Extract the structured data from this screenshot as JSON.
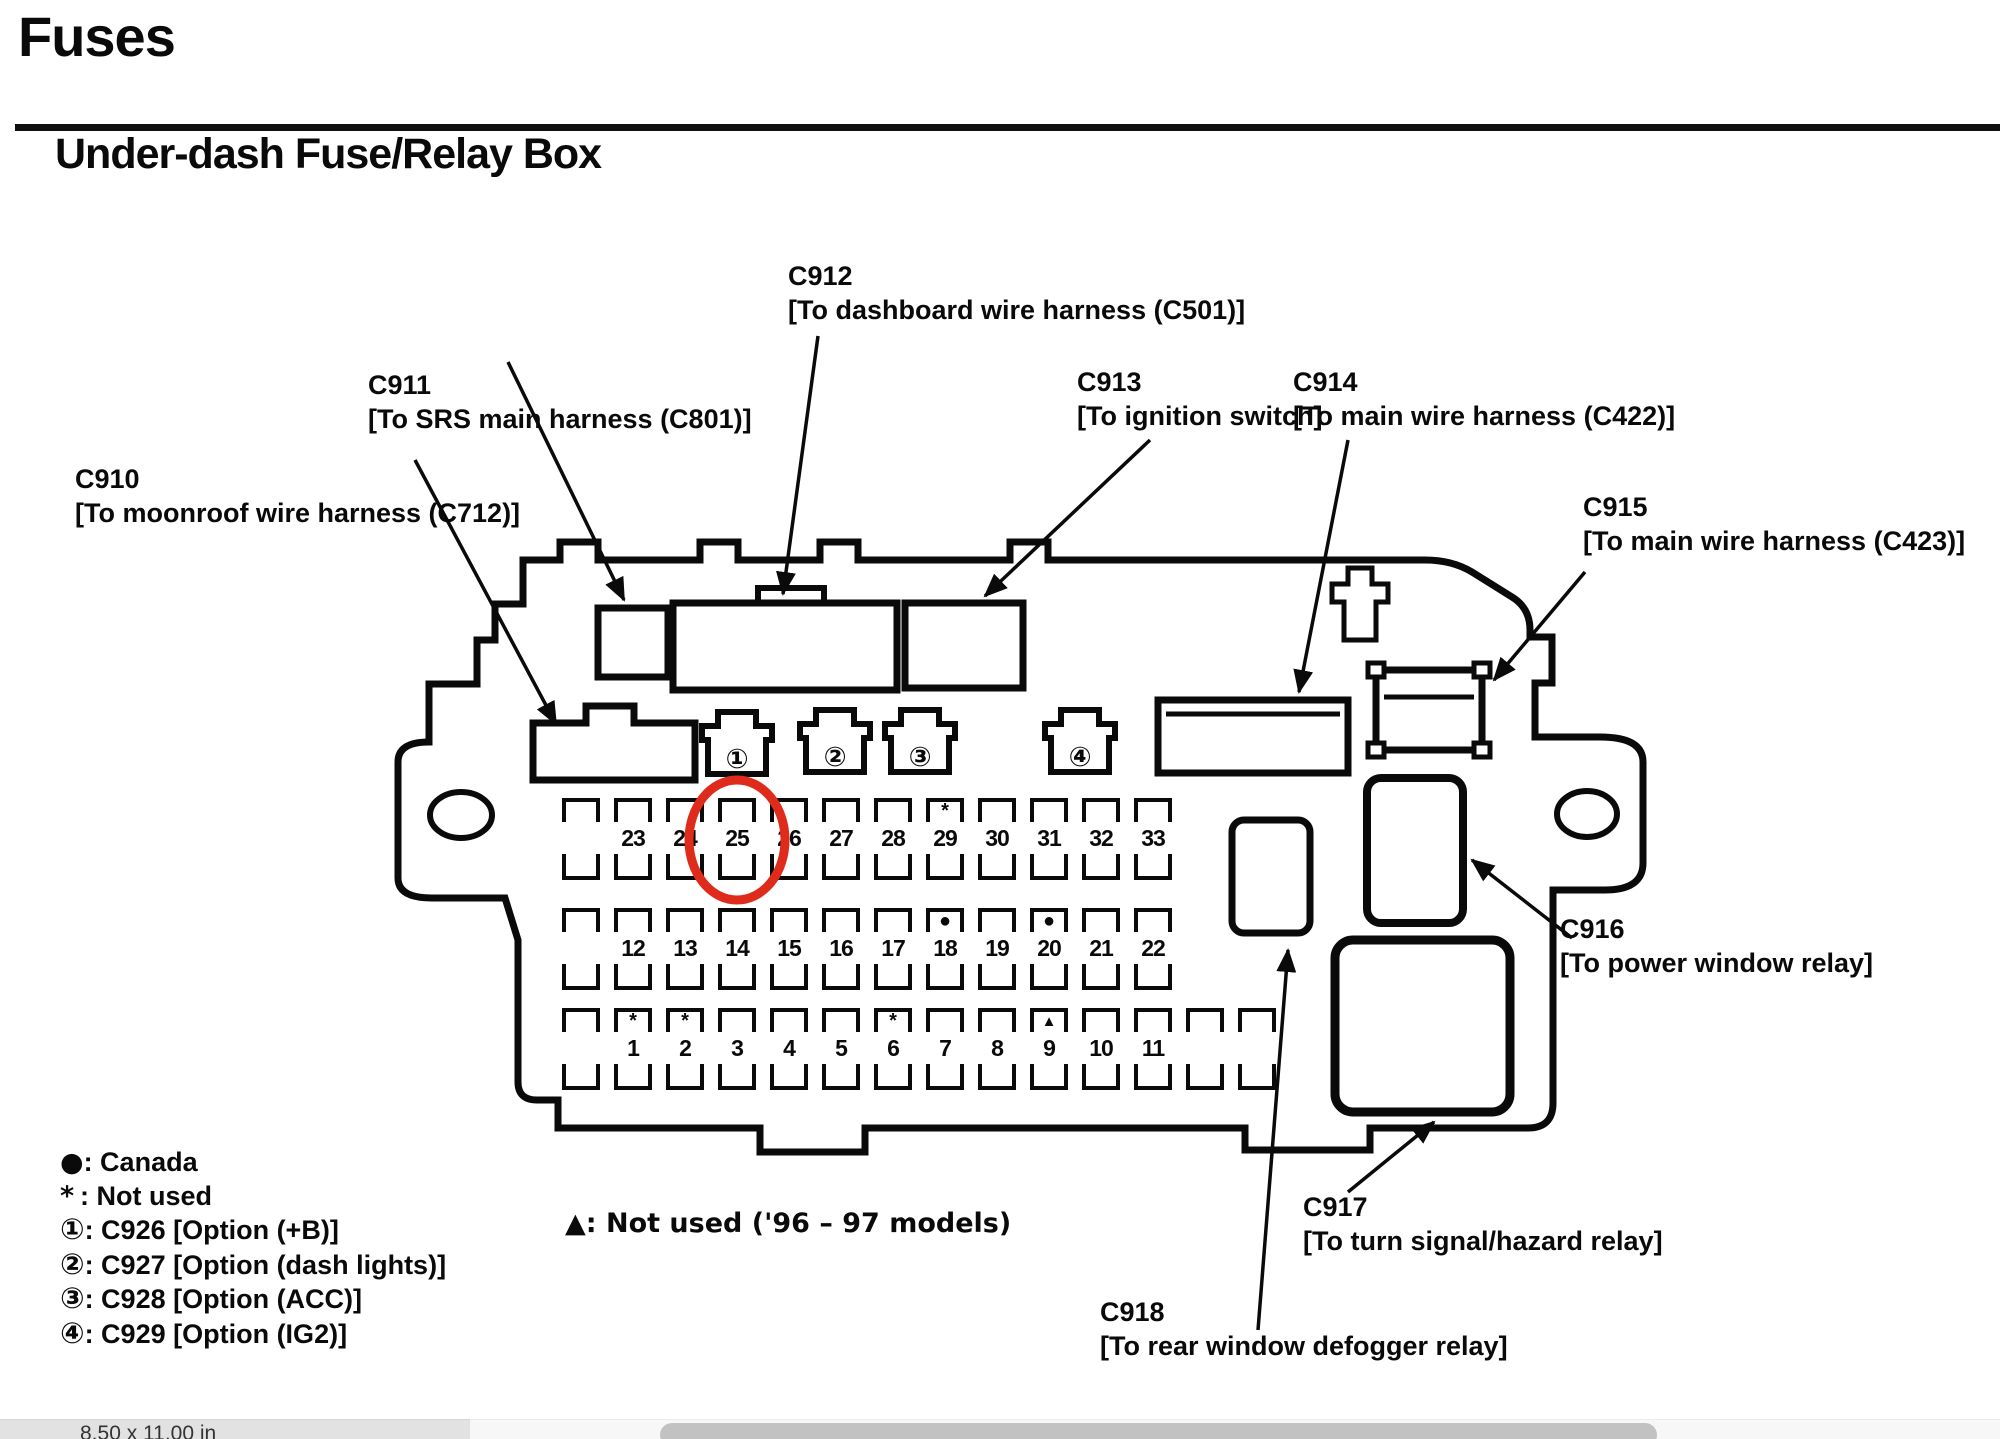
{
  "header": {
    "title": "Fuses",
    "subtitle": "Under-dash Fuse/Relay Box"
  },
  "connector_labels": [
    {
      "id": "C910",
      "desc": "[To moonroof wire harness (C712)]"
    },
    {
      "id": "C911",
      "desc": "[To SRS main harness (C801)]"
    },
    {
      "id": "C912",
      "desc": "[To dashboard wire harness (C501)]"
    },
    {
      "id": "C913",
      "desc": "[To ignition switch]"
    },
    {
      "id": "C914",
      "desc": "[To main wire harness (C422)]"
    },
    {
      "id": "C915",
      "desc": "[To main wire harness (C423)]"
    },
    {
      "id": "C916",
      "desc": "[To power window relay]"
    },
    {
      "id": "C917",
      "desc": "[To turn signal/hazard relay]"
    },
    {
      "id": "C918",
      "desc": "[To rear window defogger relay]"
    }
  ],
  "fuse_box": {
    "plug_numbers": [
      "①",
      "②",
      "③",
      "④"
    ],
    "rows": [
      {
        "cells": [
          "",
          "23",
          "24",
          "25",
          "26",
          "27",
          "28",
          "29",
          "30",
          "31",
          "32",
          "33"
        ],
        "markers": {
          "29": "*"
        }
      },
      {
        "cells": [
          "",
          "12",
          "13",
          "14",
          "15",
          "16",
          "17",
          "18",
          "19",
          "20",
          "21",
          "22"
        ],
        "markers": {
          "18": "●",
          "20": "●"
        }
      },
      {
        "cells": [
          "",
          "1",
          "2",
          "3",
          "4",
          "5",
          "6",
          "7",
          "8",
          "9",
          "10",
          "11",
          "",
          ""
        ],
        "markers": {
          "1": "*",
          "2": "*",
          "6": "*",
          "9": "▲"
        }
      }
    ],
    "highlighted_fuse": "25",
    "highlight_color": "#df2b1c"
  },
  "legend": {
    "items": [
      {
        "symbol": "●",
        "text": "Canada"
      },
      {
        "symbol": "*",
        "text": "Not used"
      },
      {
        "symbol": "①",
        "text": "C926 [Option (+B)]"
      },
      {
        "symbol": "②",
        "text": "C927 [Option (dash lights)]"
      },
      {
        "symbol": "③",
        "text": "C928 [Option (ACC)]"
      },
      {
        "symbol": "④",
        "text": "C929 [Option (IG2)]"
      }
    ],
    "triangle_note": {
      "symbol": "▲",
      "text": "Not used ('96 – 97 models)"
    }
  },
  "status_bar": {
    "page_size": "8.50 x 11.00 in"
  }
}
